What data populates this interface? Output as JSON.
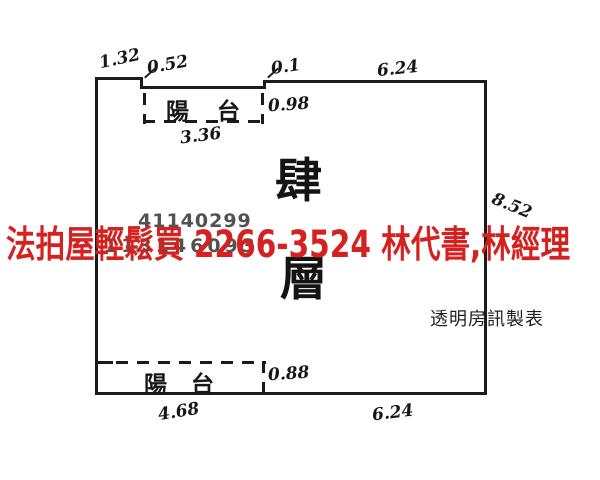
{
  "plan": {
    "floor": {
      "char_top": "肆",
      "char_bottom": "層"
    },
    "balcony_top": {
      "label": "陽 台"
    },
    "balcony_bottom": {
      "label": "陽 台"
    },
    "dims": {
      "top_left_width": "1.32",
      "top_notch": "0.52",
      "top_step": "0.1",
      "top_right_width": "6.24",
      "balcony_top_depth": "0.98",
      "balcony_top_width": "3.36",
      "right_height": "8.52",
      "balcony_bottom_depth": "0.88",
      "bottom_left_width": "4.68",
      "bottom_right_width": "6.24"
    },
    "watermark": {
      "line1": "41140299",
      "line2": "113146093"
    },
    "maker_credit": "透明房訊製表"
  },
  "overlay": {
    "ad_text": "法拍屋輕鬆買 2266-3524  林代書,林經理",
    "ad_color": "#d32220"
  },
  "colors": {
    "line": "#1b1b1b",
    "watermark_gray": "#525252",
    "background": "#ffffff"
  }
}
